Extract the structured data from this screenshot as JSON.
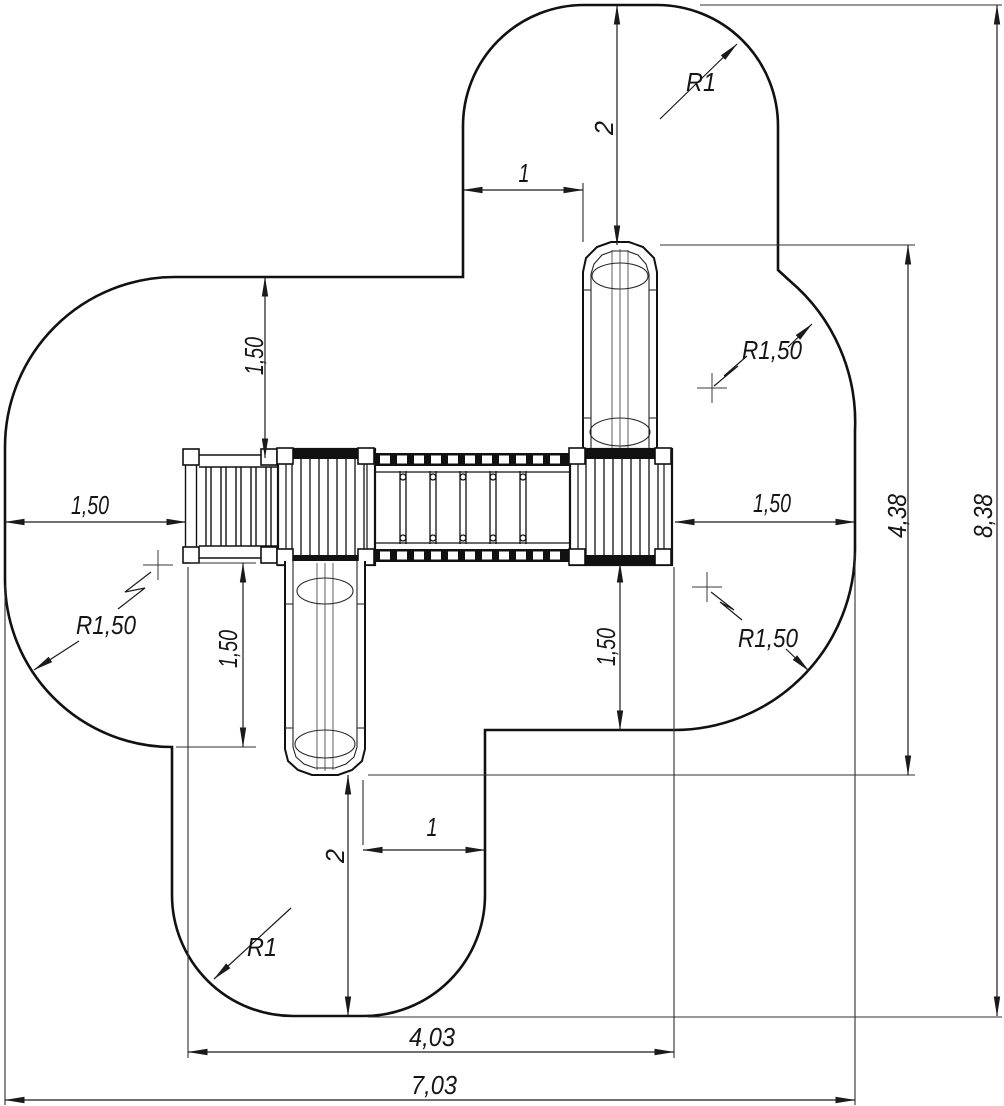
{
  "colors": {
    "ink": "#1a1a1a",
    "thin_line": "#2f2f2f",
    "background": "#ffffff"
  },
  "dim_labels": {
    "clearance_left": "1,50",
    "clearance_top": "1,50",
    "slide_top_zone": "2",
    "slide_top_offset": "1",
    "corner_radius_top": "R1",
    "corner_radius_right_top": "R1,50",
    "clearance_right": "1,50",
    "equipment_height": "4,38",
    "overall_height": "8,38",
    "corner_radius_right_bottom": "R1,50",
    "corner_radius_left": "R1,50",
    "clearance_bottom_left": "1,50",
    "clearance_bottom_right": "1,50",
    "slide_bottom_zone": "2",
    "slide_bottom_offset": "1",
    "corner_radius_bottom": "R1",
    "equipment_width": "4,03",
    "overall_width": "7,03"
  }
}
